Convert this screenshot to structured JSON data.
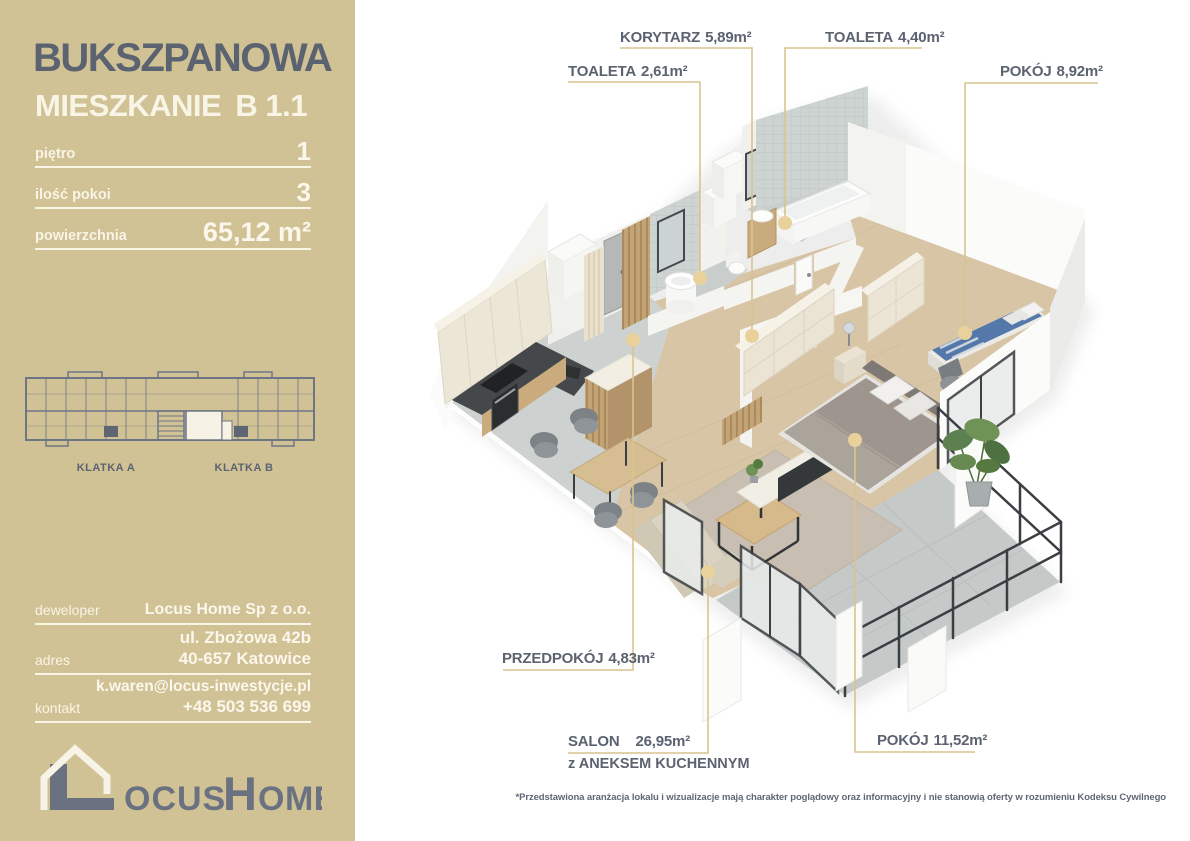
{
  "colors": {
    "sidebar_bg": "#d1c295",
    "heading_slate": "#5b6370",
    "cream_text": "#f8f4e6",
    "leader_line": "#d9c48e",
    "leader_dot": "#e9d19c"
  },
  "sidebar": {
    "project_title": "BUKSZPANOWA",
    "unit_label": "MIESZKANIE",
    "unit_number": "B 1.1",
    "specs": [
      {
        "label": "piętro",
        "value": "1"
      },
      {
        "label": "ilość pokoi",
        "value": "3"
      },
      {
        "label": "powierzchnia",
        "value": "65,12 m²"
      }
    ],
    "building_diagram": {
      "klatka_a": "KLATKA A",
      "klatka_b": "KLATKA B"
    },
    "contact": {
      "developer_label": "deweloper",
      "developer": "Locus Home Sp z o.o.",
      "address_label": "adres",
      "address_line1": "ul. Zbożowa 42b",
      "address_line2": "40-657 Katowice",
      "contact_label": "kontakt",
      "email": "k.waren@locus-inwestycje.pl",
      "phone": "+48 503 536 699"
    },
    "logo": {
      "rest1": "OCUS",
      "initial2": "H",
      "rest2": "OME"
    }
  },
  "plan": {
    "labels": [
      {
        "id": "toaleta-261",
        "name": "TOALETA",
        "area": "2,61m²"
      },
      {
        "id": "korytarz",
        "name": "KORYTARZ",
        "area": "5,89m²"
      },
      {
        "id": "toaleta-440",
        "name": "TOALETA",
        "area": "4,40m²"
      },
      {
        "id": "pokoj-892",
        "name": "POKÓJ",
        "area": "8,92m²"
      },
      {
        "id": "przedpokoj",
        "name": "PRZEDPOKÓJ",
        "area": "4,83m²"
      },
      {
        "id": "salon",
        "name": "SALON",
        "area": "26,95m²",
        "sub": "z ANEKSEM KUCHENNYM"
      },
      {
        "id": "pokoj-1152",
        "name": "POKÓJ",
        "area": "11,52m²"
      }
    ],
    "footnote": "*Przedstawiona aranżacja lokalu i wizualizacje mają charakter poglądowy oraz informacyjny i nie stanowią oferty w rozumieniu Kodeksu Cywilnego"
  }
}
